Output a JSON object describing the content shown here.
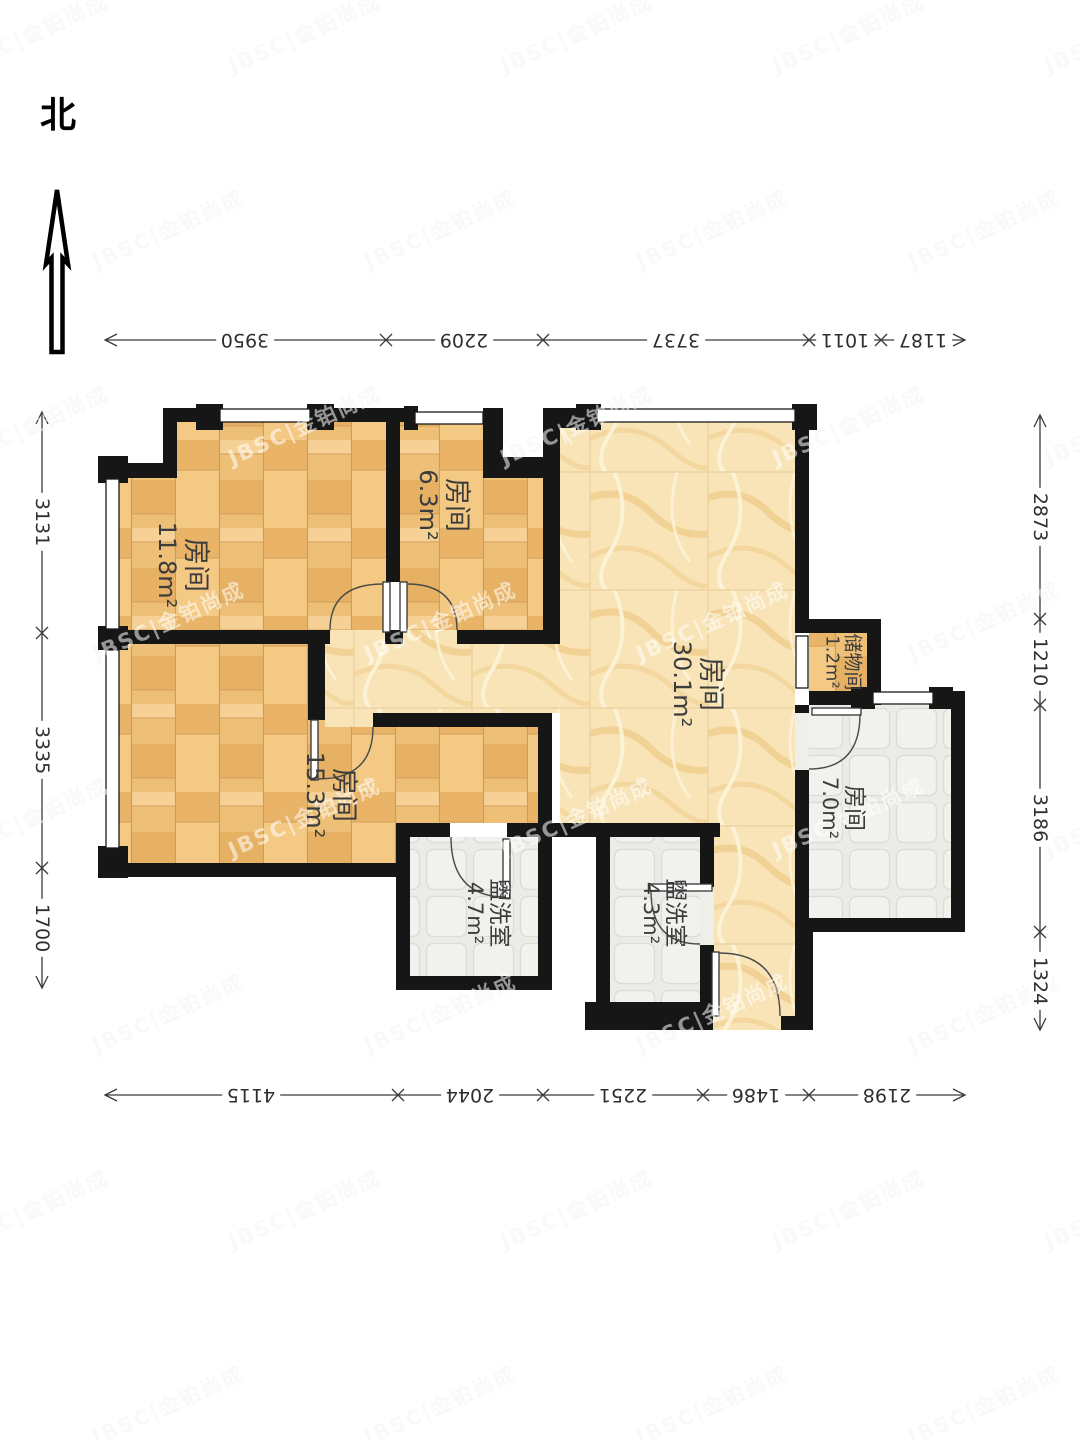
{
  "compass": {
    "label": "北"
  },
  "watermark": {
    "text": "JBSC|金铂尚成"
  },
  "rooms": [
    {
      "id": "bedroom-west",
      "name": "房间",
      "area": "11.8m²"
    },
    {
      "id": "bedroom-mid",
      "name": "房间",
      "area": "6.3m²"
    },
    {
      "id": "living-room",
      "name": "房间",
      "area": "30.1m²"
    },
    {
      "id": "bedroom-south",
      "name": "房间",
      "area": "15.3m²"
    },
    {
      "id": "storage",
      "name": "储物间",
      "area": "1.2m²"
    },
    {
      "id": "room-east",
      "name": "房间",
      "area": "7.0m²"
    },
    {
      "id": "washroom-west",
      "name": "盥洗室",
      "area": "4.7m²"
    },
    {
      "id": "washroom-east",
      "name": "盥洗室",
      "area": "4.3m²"
    }
  ],
  "dims": {
    "top": [
      "3950",
      "2209",
      "3737",
      "1011",
      "1187"
    ],
    "bottom": [
      "4115",
      "2044",
      "2251",
      "1486",
      "2198"
    ],
    "left": [
      "3131",
      "3335",
      "1700"
    ],
    "right": [
      "2873",
      "1210",
      "3186",
      "1324"
    ]
  },
  "colors": {
    "wall": "#161616",
    "wood": "#eec077",
    "marble": "#f8e4b6",
    "tile": "#ebebe7",
    "dim_line": "#3a3a3a"
  }
}
